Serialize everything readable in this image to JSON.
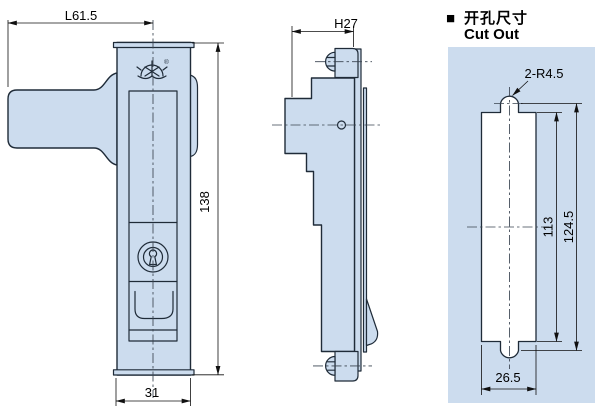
{
  "cutout_header": {
    "marker": "■",
    "title_cn": "开孔尺寸",
    "title_en": "Cut Out"
  },
  "front_view": {
    "dim_handle_length": "L61.5",
    "dim_total_height": "138",
    "dim_body_width": "31",
    "registered_mark": "®"
  },
  "side_view": {
    "dim_depth": "H27"
  },
  "cutout_view": {
    "dim_notch_radius": "2-R4.5",
    "dim_inner_length": "113",
    "dim_overall_length": "124.5",
    "dim_slot_width": "26.5"
  },
  "colors": {
    "background": "#ffffff",
    "part_fill": "#ccdcee",
    "outline": "#1f2b38",
    "cutout_panel_fill": "#ccdcee",
    "cutout_hole_fill": "#ffffff",
    "dimension_color": "#101010"
  },
  "icons": {
    "brand_logo": "crown-over-waves-emblem",
    "keyhole": "key-cylinder-keyhole"
  }
}
